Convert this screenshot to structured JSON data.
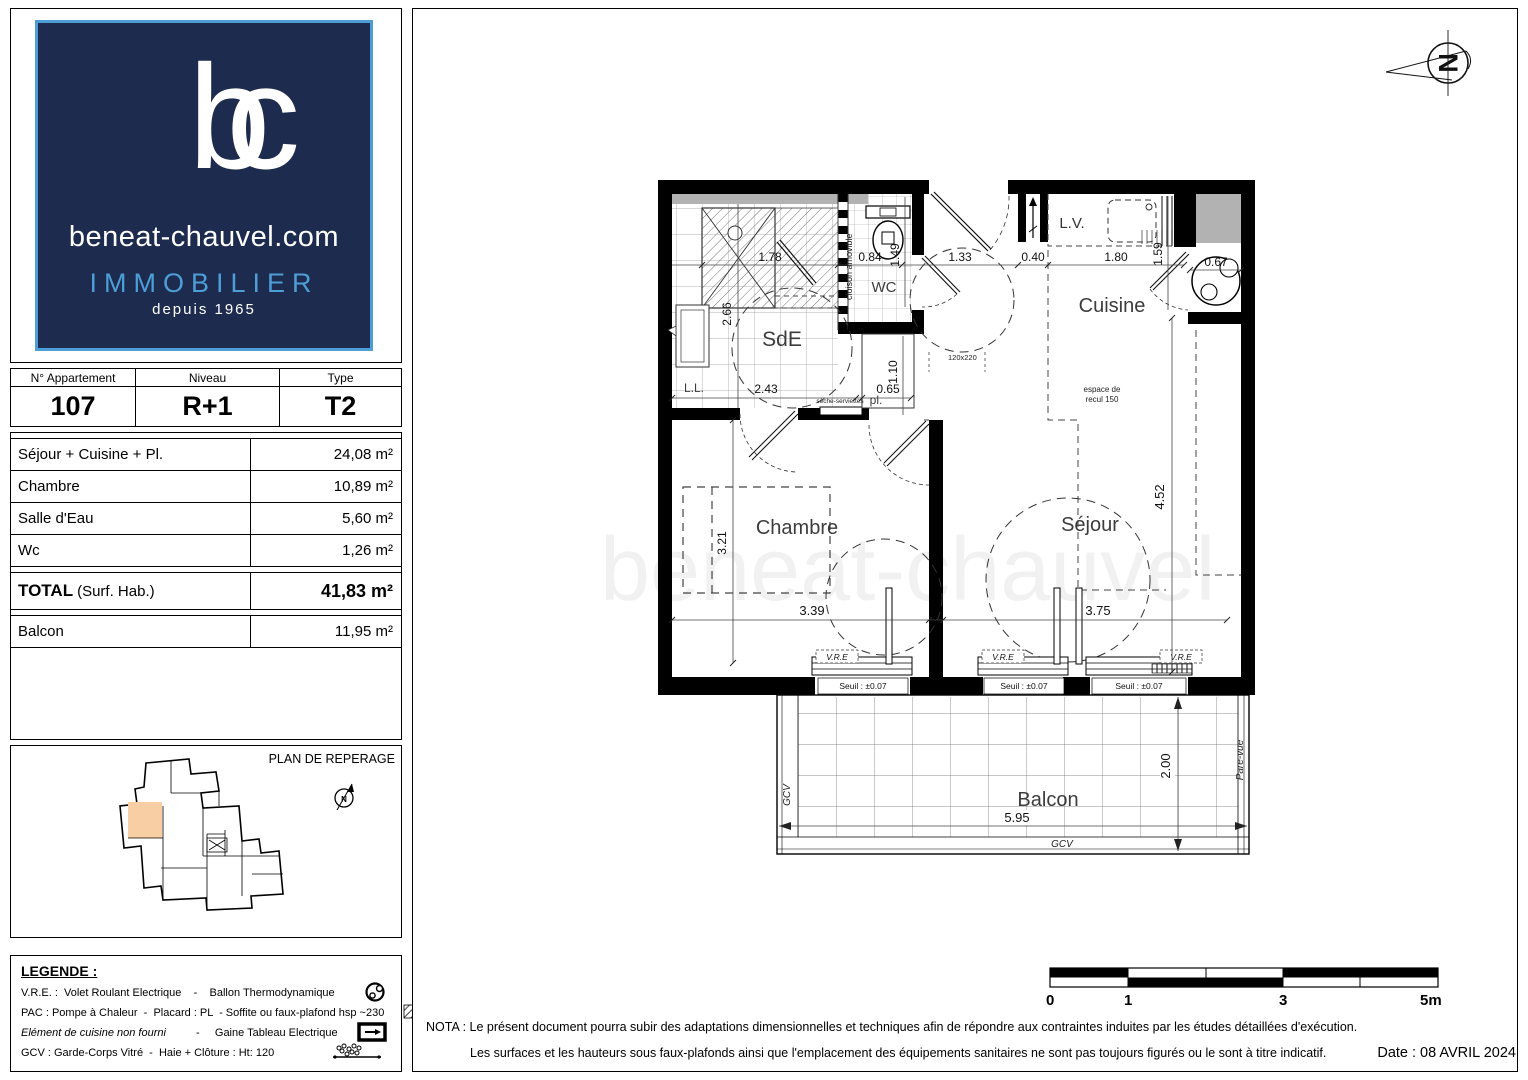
{
  "brand": {
    "monogram": "bc",
    "domain": "beneat-chauvel.com",
    "tagline": "IMMOBILIER",
    "since": "depuis 1965"
  },
  "apartment": {
    "headers": [
      "N° Appartement",
      "Niveau",
      "Type"
    ],
    "number": "107",
    "level": "R+1",
    "type": "T2"
  },
  "surfaces": {
    "rows": [
      {
        "label": "Séjour + Cuisine + Pl.",
        "value": "24,08 m²"
      },
      {
        "label": "Chambre",
        "value": "10,89 m²"
      },
      {
        "label": "Salle d'Eau",
        "value": "5,60 m²"
      },
      {
        "label": "Wc",
        "value": "1,26 m²"
      }
    ],
    "total_label": "TOTAL",
    "total_paren": "(Surf. Hab.)",
    "total_value": "41,83 m²",
    "balcon_label": "Balcon",
    "balcon_value": "11,95 m²"
  },
  "reperage": {
    "title": "PLAN DE REPERAGE"
  },
  "legende": {
    "title": "LEGENDE :",
    "l1": "V.R.E. :  Volet Roulant Electrique    -    Ballon Thermodynamique",
    "l2": "PAC : Pompe à Chaleur  -  Placard : PL  - Soffite ou faux-plafond hsp ~230",
    "l3a": "Elément de cuisine non fourni",
    "l3b": "-     Gaine Tableau Electrique",
    "l4": "GCV : Garde-Corps Vitré  -  Haie + Clôture : Ht: 120"
  },
  "plan": {
    "rooms": {
      "sde": "SdE",
      "wc": "WC",
      "cuisine": "Cuisine",
      "chambre": "Chambre",
      "sejour": "Séjour",
      "balcon": "Balcon",
      "pl": "pl."
    },
    "labels": {
      "ll": "L.L.",
      "lv": "L.V.",
      "cloison": "cloison amovible",
      "espace1": "espace de",
      "espace2": "recul 150",
      "porte": "120x220",
      "vre": "V.R.E",
      "seuil": "Seuil : ±0.07",
      "gcv": "GCV",
      "parevue": "Pare-vue",
      "seche": "sèche-serviettes"
    },
    "dims": {
      "d178": "1.78",
      "d266": "2.66",
      "d243": "2.43",
      "d084": "0.84",
      "d149": "1.49",
      "d133": "1.33",
      "d040": "0.40",
      "d180": "1.80",
      "d159": "1.59",
      "d067": "0.67",
      "d065": "0.65",
      "d110": "1.10",
      "d321": "3.21",
      "d339": "3.39",
      "d375": "3.75",
      "d452": "4.52",
      "d595": "5.95",
      "d200": "2.00"
    }
  },
  "scalebar": {
    "t0": "0",
    "t1": "1",
    "t2": "3",
    "t3": "5m"
  },
  "nota": {
    "line1": "NOTA : Le présent document pourra subir des adaptations dimensionnelles et techniques afin de répondre aux contraintes induites par les études détaillées d'exécution.",
    "line2": "Les surfaces et les hauteurs sous faux-plafonds ainsi que l'emplacement des équipements sanitaires ne sont pas toujours figurés ou le sont à titre indicatif.",
    "date": "Date : 08 AVRIL 2024"
  }
}
